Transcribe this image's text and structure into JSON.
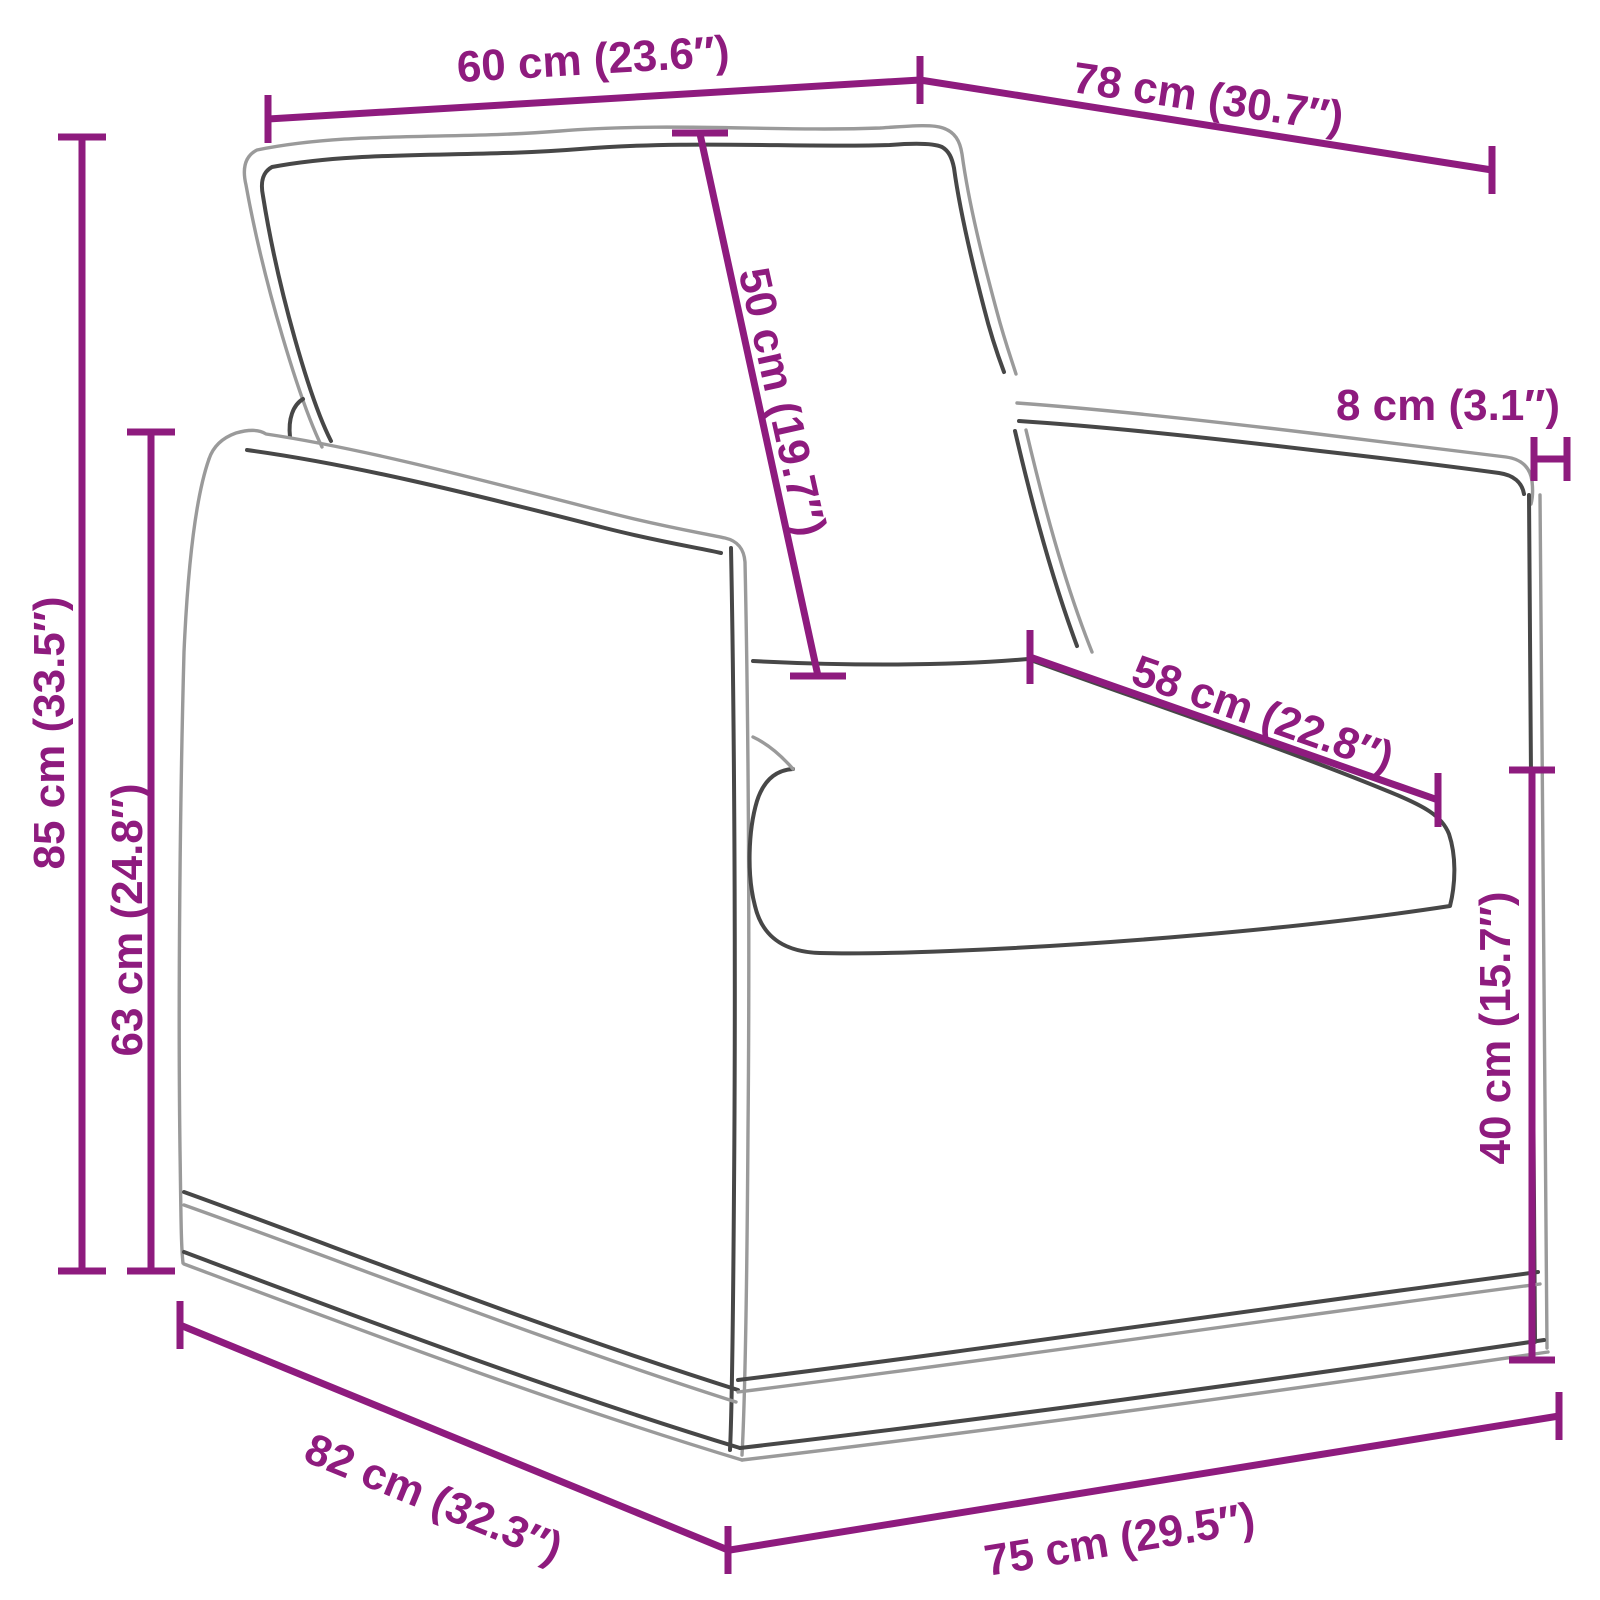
{
  "diagram": {
    "type": "product-dimension-diagram",
    "subject": "armchair line drawing with measurement annotations",
    "background_color": "#ffffff",
    "accent_color": "#8e1b7e",
    "outline_color": "#474747"
  },
  "dimensions": [
    {
      "id": "top-front-width",
      "label": "60 cm (23.6″)",
      "cm": 60,
      "inches": 23.6
    },
    {
      "id": "top-side-depth",
      "label": "78 cm (30.7″)",
      "cm": 78,
      "inches": 30.7
    },
    {
      "id": "back-cushion-height",
      "label": "50 cm (19.7″)",
      "cm": 50,
      "inches": 19.7
    },
    {
      "id": "armrest-width",
      "label": "8 cm (3.1″)",
      "cm": 8,
      "inches": 3.1
    },
    {
      "id": "overall-height",
      "label": "85 cm (33.5″)",
      "cm": 85,
      "inches": 33.5
    },
    {
      "id": "arm-height",
      "label": "63 cm (24.8″)",
      "cm": 63,
      "inches": 24.8
    },
    {
      "id": "seat-depth",
      "label": "58 cm (22.8″)",
      "cm": 58,
      "inches": 22.8
    },
    {
      "id": "seat-height",
      "label": "40 cm (15.7″)",
      "cm": 40,
      "inches": 15.7
    },
    {
      "id": "base-depth",
      "label": "82 cm (32.3″)",
      "cm": 82,
      "inches": 32.3
    },
    {
      "id": "base-front-width",
      "label": "75 cm (29.5″)",
      "cm": 75,
      "inches": 29.5
    }
  ]
}
